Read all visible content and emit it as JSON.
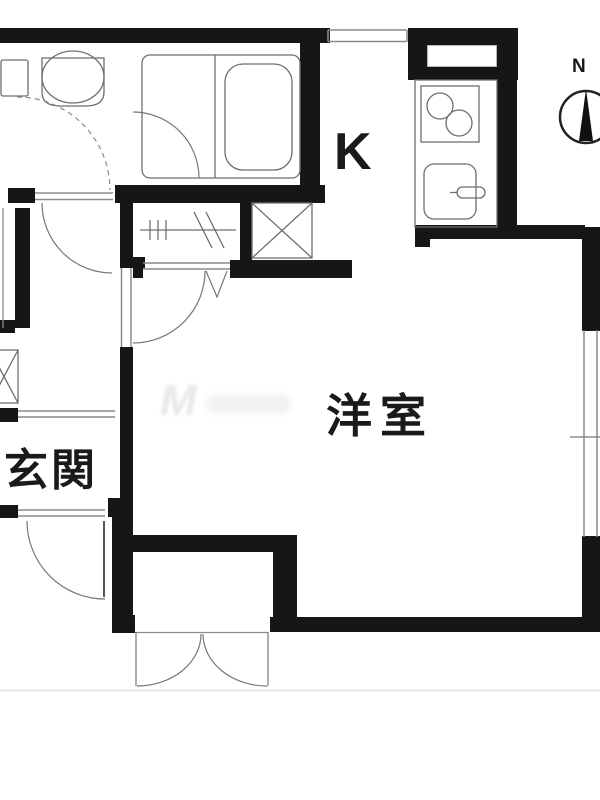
{
  "title": "apartment-floor-plan",
  "labels": {
    "kitchen": "K",
    "western_room": "洋室",
    "entrance": "玄関",
    "compass_north": "N"
  },
  "watermark": "M",
  "colors": {
    "wall": "#161616",
    "fixture_line": "#6e6e6e",
    "opening_line": "#8a8a8a",
    "background": "#ffffff",
    "bottom_edge": "#ededed",
    "text": "#1a1a1a"
  },
  "fixtures": [
    "toilet",
    "toilet-tank",
    "toilet-door-swing",
    "bathtub",
    "bath-unit",
    "bath-door-swing",
    "hanger-rack",
    "bifold-closet-door",
    "crossed-shaft-box",
    "crossed-shaft-box-left",
    "kitchen-counter",
    "stove-two-burner",
    "kitchen-sink",
    "faucet",
    "hall-room-door-swing",
    "entrance-door-swing",
    "double-swing-storage-door",
    "window-top",
    "window-kitchen",
    "window-right",
    "compass"
  ]
}
